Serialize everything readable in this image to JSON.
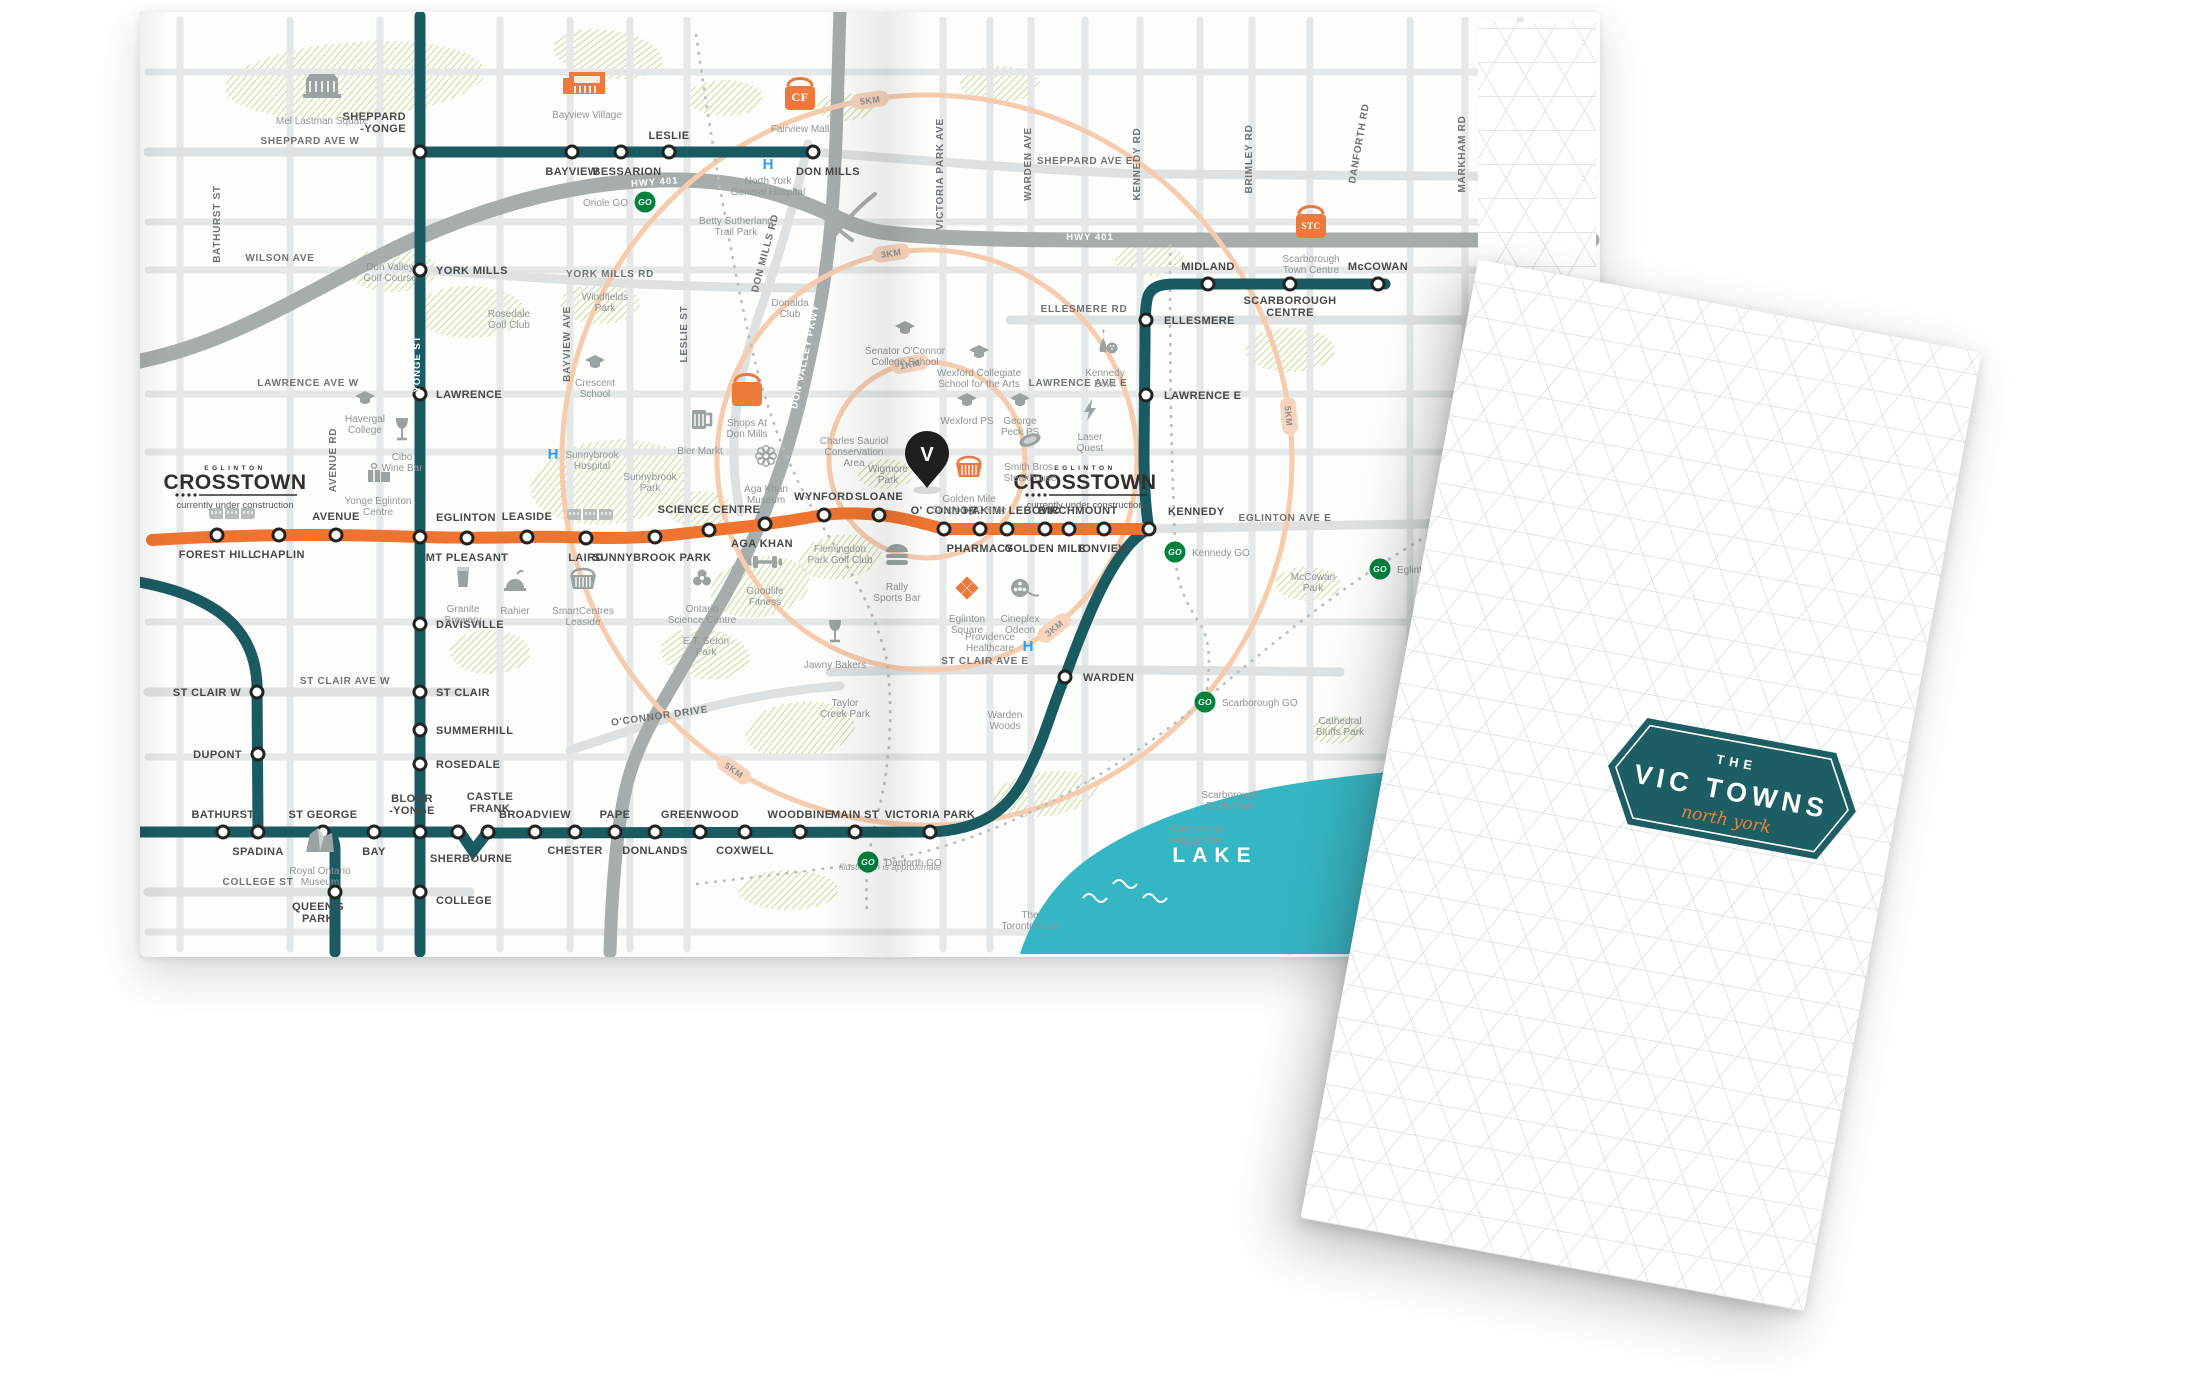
{
  "cover": {
    "kicker": "THE",
    "title": "VIC TOWNS",
    "script": "north york"
  },
  "map": {
    "note": "Illustration is approximate",
    "lake_label": "LAKE",
    "crosstown_logo": {
      "top": "EGLINTON",
      "main": "CROSSTOWN",
      "sub": "currently under construction"
    },
    "logo_positions": [
      {
        "x": 95,
        "y": 458
      },
      {
        "x": 945,
        "y": 458
      }
    ],
    "colors": {
      "subway": "#1A5B61",
      "crosstown": "#EE7430",
      "go_green": "#00813D",
      "ring": "#F6CBAE",
      "ring_pill": "#F8D4BC",
      "lake": "#35B6C4",
      "hospital_blue": "#2E9DF2",
      "park": "#BFDB8E",
      "icon_gray": "#9AA2A2",
      "icon_orange": "#ED7A3C",
      "pin_black": "#1F1F1D"
    },
    "pin": {
      "x": 787,
      "y": 448,
      "letter": "V"
    },
    "rings": {
      "center": {
        "x": 787,
        "y": 448
      },
      "radii": [
        98,
        210,
        365
      ],
      "labels": [
        {
          "t": "1KM",
          "x": 770,
          "y": 352,
          "r": -10
        },
        {
          "t": "3KM",
          "x": 751,
          "y": 241,
          "r": -8
        },
        {
          "t": "3KM",
          "x": 914,
          "y": 616,
          "r": -38
        },
        {
          "t": "5KM",
          "x": 730,
          "y": 88,
          "r": -8
        },
        {
          "t": "5KM",
          "x": 1149,
          "y": 404,
          "r": 85
        },
        {
          "t": "5KM",
          "x": 594,
          "y": 758,
          "r": 35
        }
      ]
    },
    "trains": [
      {
        "x": 92,
        "y": 502
      },
      {
        "x": 450,
        "y": 503
      }
    ],
    "subway_stations": [
      {
        "n": "SHEPPARD\n-YONGE",
        "x": 280,
        "y": 140,
        "lx": 266,
        "ly": 108,
        "a": "e"
      },
      {
        "n": "BAYVIEW",
        "x": 432,
        "y": 140,
        "lx": 432,
        "ly": 163,
        "a": "m"
      },
      {
        "n": "BESSARION",
        "x": 481,
        "y": 140,
        "lx": 487,
        "ly": 163,
        "a": "m"
      },
      {
        "n": "LESLIE",
        "x": 529,
        "y": 140,
        "lx": 529,
        "ly": 127,
        "a": "m"
      },
      {
        "n": "DON MILLS",
        "x": 673,
        "y": 140,
        "lx": 688,
        "ly": 163,
        "a": "m"
      },
      {
        "n": "YORK MILLS",
        "x": 280,
        "y": 258,
        "lx": 296,
        "ly": 262,
        "a": "s"
      },
      {
        "n": "LAWRENCE",
        "x": 280,
        "y": 382,
        "lx": 296,
        "ly": 386,
        "a": "s"
      },
      {
        "n": "EGLINTON",
        "x": 280,
        "y": 525,
        "lx": 296,
        "ly": 509,
        "a": "s"
      },
      {
        "n": "DAVISVILLE",
        "x": 280,
        "y": 612,
        "lx": 296,
        "ly": 616,
        "a": "s"
      },
      {
        "n": "ST CLAIR",
        "x": 280,
        "y": 680,
        "lx": 296,
        "ly": 684,
        "a": "s"
      },
      {
        "n": "SUMMERHILL",
        "x": 280,
        "y": 718,
        "lx": 296,
        "ly": 722,
        "a": "s"
      },
      {
        "n": "ROSEDALE",
        "x": 280,
        "y": 752,
        "lx": 296,
        "ly": 756,
        "a": "s"
      },
      {
        "n": "BLOOR\n-YONGE",
        "x": 280,
        "y": 820,
        "lx": 272,
        "ly": 790,
        "a": "m"
      },
      {
        "n": "COLLEGE",
        "x": 280,
        "y": 880,
        "lx": 296,
        "ly": 892,
        "a": "s"
      },
      {
        "n": "ST CLAIR W",
        "x": 117,
        "y": 680,
        "lx": 101,
        "ly": 684,
        "a": "e"
      },
      {
        "n": "DUPONT",
        "x": 118,
        "y": 742,
        "lx": 102,
        "ly": 746,
        "a": "e"
      },
      {
        "n": "SPADINA",
        "x": 118,
        "y": 820,
        "lx": 118,
        "ly": 843,
        "a": "m"
      },
      {
        "n": "BATHURST",
        "x": 83,
        "y": 820,
        "lx": 83,
        "ly": 806,
        "a": "m"
      },
      {
        "n": "ST GEORGE",
        "x": 183,
        "y": 820,
        "lx": 183,
        "ly": 806,
        "a": "m"
      },
      {
        "n": "BAY",
        "x": 234,
        "y": 820,
        "lx": 234,
        "ly": 843,
        "a": "m"
      },
      {
        "n": "QUEEN'S\nPARK",
        "x": 195,
        "y": 880,
        "lx": 178,
        "ly": 898,
        "a": "m"
      },
      {
        "n": "SHERBOURNE",
        "x": 318,
        "y": 820,
        "lx": 290,
        "ly": 850,
        "a": "s"
      },
      {
        "n": "CASTLE\nFRANK",
        "x": 348,
        "y": 820,
        "lx": 350,
        "ly": 788,
        "a": "m"
      },
      {
        "n": "BROADVIEW",
        "x": 395,
        "y": 820,
        "lx": 395,
        "ly": 806,
        "a": "m"
      },
      {
        "n": "CHESTER",
        "x": 435,
        "y": 820,
        "lx": 435,
        "ly": 842,
        "a": "m"
      },
      {
        "n": "PAPE",
        "x": 475,
        "y": 820,
        "lx": 475,
        "ly": 806,
        "a": "m"
      },
      {
        "n": "DONLANDS",
        "x": 515,
        "y": 820,
        "lx": 515,
        "ly": 842,
        "a": "m"
      },
      {
        "n": "GREENWOOD",
        "x": 560,
        "y": 820,
        "lx": 560,
        "ly": 806,
        "a": "m"
      },
      {
        "n": "COXWELL",
        "x": 605,
        "y": 820,
        "lx": 605,
        "ly": 842,
        "a": "m"
      },
      {
        "n": "WOODBINE",
        "x": 660,
        "y": 820,
        "lx": 660,
        "ly": 806,
        "a": "m"
      },
      {
        "n": "MAIN ST",
        "x": 715,
        "y": 820,
        "lx": 715,
        "ly": 806,
        "a": "m"
      },
      {
        "n": "VICTORIA PARK",
        "x": 790,
        "y": 820,
        "lx": 790,
        "ly": 806,
        "a": "m"
      },
      {
        "n": "WARDEN",
        "x": 925,
        "y": 665,
        "lx": 943,
        "ly": 669,
        "a": "s"
      },
      {
        "n": "KENNEDY",
        "x": 1009,
        "y": 517,
        "lx": 1028,
        "ly": 503,
        "a": "s"
      },
      {
        "n": "LAWRENCE E",
        "x": 1006,
        "y": 383,
        "lx": 1024,
        "ly": 387,
        "a": "s"
      },
      {
        "n": "ELLESMERE",
        "x": 1006,
        "y": 308,
        "lx": 1024,
        "ly": 312,
        "a": "s"
      },
      {
        "n": "MIDLAND",
        "x": 1068,
        "y": 272,
        "lx": 1068,
        "ly": 258,
        "a": "m"
      },
      {
        "n": "SCARBOROUGH\nCENTRE",
        "x": 1150,
        "y": 272,
        "lx": 1150,
        "ly": 292,
        "a": "m"
      },
      {
        "n": "McCOWAN",
        "x": 1238,
        "y": 272,
        "lx": 1238,
        "ly": 258,
        "a": "m"
      }
    ],
    "crosstown_stations": [
      {
        "n": "FOREST HILL",
        "x": 77,
        "y": 523,
        "lx": 77,
        "ly": 546,
        "a": "m"
      },
      {
        "n": "CHAPLIN",
        "x": 139,
        "y": 523,
        "lx": 139,
        "ly": 546,
        "a": "m"
      },
      {
        "n": "AVENUE",
        "x": 196,
        "y": 523,
        "lx": 196,
        "ly": 508,
        "a": "m"
      },
      {
        "n": "MT PLEASANT",
        "x": 327,
        "y": 526,
        "lx": 327,
        "ly": 549,
        "a": "m"
      },
      {
        "n": "LEASIDE",
        "x": 387,
        "y": 525,
        "lx": 387,
        "ly": 508,
        "a": "m"
      },
      {
        "n": "LAIRD",
        "x": 446,
        "y": 526,
        "lx": 446,
        "ly": 549,
        "a": "m"
      },
      {
        "n": "SUNNYBROOK PARK",
        "x": 515,
        "y": 525,
        "lx": 512,
        "ly": 549,
        "a": "m"
      },
      {
        "n": "SCIENCE CENTRE",
        "x": 569,
        "y": 518,
        "lx": 569,
        "ly": 501,
        "a": "m"
      },
      {
        "n": "AGA KHAN",
        "x": 625,
        "y": 512,
        "lx": 622,
        "ly": 535,
        "a": "m"
      },
      {
        "n": "WYNFORD",
        "x": 684,
        "y": 503,
        "lx": 684,
        "ly": 488,
        "a": "m"
      },
      {
        "n": "SLOANE",
        "x": 739,
        "y": 503,
        "lx": 739,
        "ly": 488,
        "a": "m"
      },
      {
        "n": "O' CONNOR",
        "x": 804,
        "y": 517,
        "lx": 804,
        "ly": 502,
        "a": "m"
      },
      {
        "n": "PHARMACY",
        "x": 840,
        "y": 517,
        "lx": 840,
        "ly": 540,
        "a": "m"
      },
      {
        "n": "HAKIMI LEBOVIC",
        "x": 867,
        "y": 517,
        "lx": 872,
        "ly": 502,
        "a": "m"
      },
      {
        "n": "GOLDEN MILE",
        "x": 905,
        "y": 517,
        "lx": 905,
        "ly": 540,
        "a": "m"
      },
      {
        "n": "BIRCHMOUNT",
        "x": 929,
        "y": 517,
        "lx": 938,
        "ly": 502,
        "a": "m"
      },
      {
        "n": "IONVIEW",
        "x": 964,
        "y": 517,
        "lx": 964,
        "ly": 540,
        "a": "m"
      }
    ],
    "go_stations": [
      {
        "n": "Oriole GO",
        "x": 505,
        "y": 190,
        "lx": 488,
        "ly": 194,
        "a": "e"
      },
      {
        "n": "Kennedy GO",
        "x": 1035,
        "y": 540,
        "lx": 1052,
        "ly": 544,
        "a": "s"
      },
      {
        "n": "Eglinton GO",
        "x": 1240,
        "y": 557,
        "lx": 1257,
        "ly": 561,
        "a": "s"
      },
      {
        "n": "Scarborough GO",
        "x": 1065,
        "y": 690,
        "lx": 1082,
        "ly": 694,
        "a": "s"
      },
      {
        "n": "Danforth GO",
        "x": 728,
        "y": 850,
        "lx": 745,
        "ly": 854,
        "a": "s"
      }
    ],
    "street_labels": [
      {
        "n": "SHEPPARD AVE W",
        "x": 170,
        "y": 132
      },
      {
        "n": "SHEPPARD AVE E",
        "x": 945,
        "y": 152
      },
      {
        "n": "WILSON AVE",
        "x": 140,
        "y": 249
      },
      {
        "n": "YORK MILLS RD",
        "x": 470,
        "y": 265
      },
      {
        "n": "LAWRENCE AVE W",
        "x": 168,
        "y": 374
      },
      {
        "n": "LAWRENCE AVE E",
        "x": 938,
        "y": 374
      },
      {
        "n": "EGLINTON AVE E",
        "x": 1145,
        "y": 509
      },
      {
        "n": "ELLESMERE RD",
        "x": 944,
        "y": 300
      },
      {
        "n": "ST CLAIR AVE W",
        "x": 205,
        "y": 672
      },
      {
        "n": "ST CLAIR AVE E",
        "x": 845,
        "y": 652
      },
      {
        "n": "COLLEGE ST",
        "x": 118,
        "y": 873
      },
      {
        "n": "O'CONNOR DRIVE",
        "x": 520,
        "y": 707,
        "r": -8
      },
      {
        "n": "BATHURST ST",
        "x": 80,
        "y": 212,
        "r": -90
      },
      {
        "n": "AVENUE RD",
        "x": 196,
        "y": 448,
        "r": -90
      },
      {
        "n": "BAYVIEW AVE",
        "x": 430,
        "y": 332,
        "r": -90
      },
      {
        "n": "LESLIE ST",
        "x": 547,
        "y": 322,
        "r": -90
      },
      {
        "n": "DON MILLS RD",
        "x": 628,
        "y": 242,
        "r": -75
      },
      {
        "n": "VICTORIA PARK AVE",
        "x": 803,
        "y": 162,
        "r": -90
      },
      {
        "n": "WARDEN AVE",
        "x": 891,
        "y": 152,
        "r": -90
      },
      {
        "n": "KENNEDY RD",
        "x": 1000,
        "y": 152,
        "r": -90
      },
      {
        "n": "BRIMLEY RD",
        "x": 1112,
        "y": 147,
        "r": -90
      },
      {
        "n": "DANFORTH RD",
        "x": 1222,
        "y": 132,
        "r": -80
      },
      {
        "n": "MARKHAM RD",
        "x": 1325,
        "y": 142,
        "r": -90
      },
      {
        "n": "HWY 401",
        "x": 515,
        "y": 173,
        "r": -4,
        "c": "wlab"
      },
      {
        "n": "HWY 401",
        "x": 950,
        "y": 228,
        "c": "wlab"
      },
      {
        "n": "YONGE ST",
        "x": 280,
        "y": 352,
        "r": -90,
        "c": "wlab"
      },
      {
        "n": "DON VALLEY PKWY",
        "x": 668,
        "y": 345,
        "r": -78,
        "c": "wlab"
      }
    ],
    "pois": [
      {
        "n": "Mel Lastman Square",
        "i": "building",
        "x": 182,
        "y": 76,
        "lx": 182,
        "ly": 112
      },
      {
        "n": "Bayview Village",
        "i": "storefront",
        "x": 447,
        "y": 70,
        "lx": 447,
        "ly": 106
      },
      {
        "n": "Fairview Mall",
        "i": "bagCF",
        "x": 660,
        "y": 80,
        "lx": 660,
        "ly": 120
      },
      {
        "n": "North York\nGeneral Hospital",
        "i": "H",
        "x": 628,
        "y": 152,
        "lx": 628,
        "ly": 172
      },
      {
        "n": "Betty Sutherland\nTrail Park",
        "i": "",
        "x": 0,
        "y": 0,
        "lx": 596,
        "ly": 212
      },
      {
        "n": "Don Valley\nGolf Course",
        "i": "",
        "x": 0,
        "y": 0,
        "lx": 250,
        "ly": 258
      },
      {
        "n": "Rosedale\nGolf Club",
        "i": "",
        "x": 0,
        "y": 0,
        "lx": 369,
        "ly": 305
      },
      {
        "n": "Windfields\nPark",
        "i": "",
        "x": 0,
        "y": 0,
        "lx": 465,
        "ly": 288
      },
      {
        "n": "Crescent\nSchool",
        "i": "grad",
        "x": 455,
        "y": 350,
        "lx": 455,
        "ly": 374
      },
      {
        "n": "Donalda\nClub",
        "i": "",
        "x": 0,
        "y": 0,
        "lx": 650,
        "ly": 294
      },
      {
        "n": "Havergal\nCollege",
        "i": "grad",
        "x": 225,
        "y": 386,
        "lx": 225,
        "ly": 410
      },
      {
        "n": "Cibo\nWine Bar",
        "i": "wine",
        "x": 262,
        "y": 418,
        "lx": 262,
        "ly": 448
      },
      {
        "n": "Yonge Eglinton\nCentre",
        "i": "gift",
        "x": 238,
        "y": 460,
        "lx": 238,
        "ly": 492
      },
      {
        "n": "Sunnybrook\nHospital",
        "i": "H",
        "x": 413,
        "y": 442,
        "lx": 452,
        "ly": 446
      },
      {
        "n": "Sunnybrook\nPark",
        "i": "",
        "x": 0,
        "y": 0,
        "lx": 510,
        "ly": 468
      },
      {
        "n": "Shops At\nDon Mills",
        "i": "bag",
        "x": 607,
        "y": 376,
        "lx": 607,
        "ly": 414
      },
      {
        "n": "Bier Markt",
        "i": "beermug",
        "x": 560,
        "y": 408,
        "lx": 560,
        "ly": 442
      },
      {
        "n": "Aga Khan\nMuseum",
        "i": "flower",
        "x": 626,
        "y": 444,
        "lx": 626,
        "ly": 480
      },
      {
        "n": "Charles Sauriol\nConservation\nArea",
        "i": "",
        "x": 0,
        "y": 0,
        "lx": 714,
        "ly": 432
      },
      {
        "n": "Wigmore\nPark",
        "i": "",
        "x": 0,
        "y": 0,
        "lx": 748,
        "ly": 460
      },
      {
        "n": "Senator O'Connor\nCollege School",
        "i": "grad",
        "x": 765,
        "y": 316,
        "lx": 765,
        "ly": 342
      },
      {
        "n": "Wexford Collegiate\nSchool for the Arts",
        "i": "grad",
        "x": 839,
        "y": 340,
        "lx": 839,
        "ly": 364
      },
      {
        "n": "Wexford PS",
        "i": "grad",
        "x": 827,
        "y": 388,
        "lx": 827,
        "ly": 412
      },
      {
        "n": "George\nPeck PS",
        "i": "grad",
        "x": 880,
        "y": 388,
        "lx": 880,
        "ly": 412
      },
      {
        "n": "Smith Bros.\nSteakhouse",
        "i": "steak",
        "x": 890,
        "y": 428,
        "lx": 890,
        "ly": 458
      },
      {
        "n": "Golden Mile\nShopping Centre",
        "i": "basketO",
        "x": 829,
        "y": 456,
        "lx": 829,
        "ly": 490
      },
      {
        "n": "Laser\nQuest",
        "i": "bolt",
        "x": 950,
        "y": 398,
        "lx": 950,
        "ly": 428
      },
      {
        "n": "Kennedy\nBowl",
        "i": "bowling",
        "x": 965,
        "y": 330,
        "lx": 965,
        "ly": 364
      },
      {
        "n": "Eglinton\nSquare",
        "i": "diamonds",
        "x": 827,
        "y": 576,
        "lx": 827,
        "ly": 610
      },
      {
        "n": "Cineplex\nOdeon",
        "i": "film",
        "x": 880,
        "y": 576,
        "lx": 880,
        "ly": 610
      },
      {
        "n": "Providence\nHealthcare",
        "i": "H",
        "x": 888,
        "y": 634,
        "lx": 850,
        "ly": 628
      },
      {
        "n": "Rally\nSports Bar",
        "i": "burger",
        "x": 757,
        "y": 543,
        "lx": 757,
        "ly": 578
      },
      {
        "n": "Flemingdon\nPark Golf Club",
        "i": "",
        "x": 0,
        "y": 0,
        "lx": 700,
        "ly": 540
      },
      {
        "n": "Goodlife\nFitness",
        "i": "dumbbell",
        "x": 625,
        "y": 550,
        "lx": 625,
        "ly": 582
      },
      {
        "n": "Ontario\nScience Centre",
        "i": "science",
        "x": 562,
        "y": 566,
        "lx": 562,
        "ly": 600
      },
      {
        "n": "E.T. Seton\nPark",
        "i": "",
        "x": 0,
        "y": 0,
        "lx": 566,
        "ly": 632
      },
      {
        "n": "Jawny Bakers",
        "i": "wine",
        "x": 695,
        "y": 620,
        "lx": 695,
        "ly": 656
      },
      {
        "n": "Taylor\nCreek Park",
        "i": "",
        "x": 0,
        "y": 0,
        "lx": 705,
        "ly": 694
      },
      {
        "n": "Warden\nWoods",
        "i": "",
        "x": 0,
        "y": 0,
        "lx": 865,
        "ly": 706
      },
      {
        "n": "Granite\nBrewery",
        "i": "beer",
        "x": 323,
        "y": 566,
        "lx": 323,
        "ly": 600
      },
      {
        "n": "Rahier",
        "i": "cake",
        "x": 375,
        "y": 570,
        "lx": 375,
        "ly": 602
      },
      {
        "n": "SmartCentres\nLeaside",
        "i": "basket",
        "x": 443,
        "y": 568,
        "lx": 443,
        "ly": 602
      },
      {
        "n": "Royal Ontario\nMuseum",
        "i": "rom",
        "x": 180,
        "y": 830,
        "lx": 180,
        "ly": 862
      },
      {
        "n": "Scarborough\nTown Centre",
        "i": "bagSTC",
        "x": 1171,
        "y": 208,
        "lx": 1171,
        "ly": 250
      },
      {
        "n": "McCowan\nPark",
        "i": "",
        "x": 0,
        "y": 0,
        "lx": 1173,
        "ly": 568
      },
      {
        "n": "Cathedral\nBluffs Park",
        "i": "",
        "x": 0,
        "y": 0,
        "lx": 1200,
        "ly": 712
      },
      {
        "n": "Scarborough\nBluffs Park",
        "i": "",
        "x": 0,
        "y": 0,
        "lx": 1090,
        "ly": 786
      },
      {
        "n": "Scarborough\nHeights Park",
        "i": "",
        "x": 0,
        "y": 0,
        "lx": 1055,
        "ly": 820
      },
      {
        "n": "The\nToronto Hunt",
        "i": "",
        "x": 0,
        "y": 0,
        "lx": 890,
        "ly": 906
      }
    ]
  }
}
